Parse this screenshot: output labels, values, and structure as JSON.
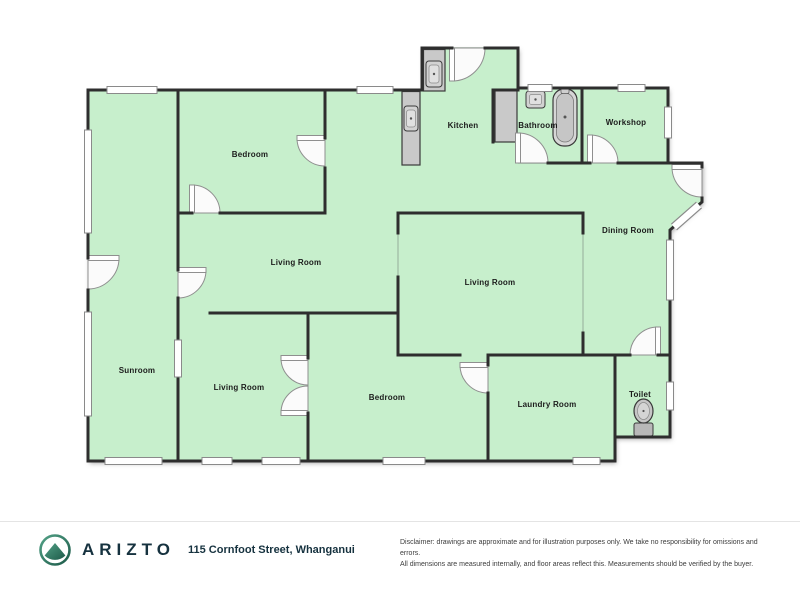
{
  "floorplan": {
    "rooms": [
      {
        "id": "bedroom-top",
        "label": "Bedroom"
      },
      {
        "id": "kitchen",
        "label": "Kitchen"
      },
      {
        "id": "bathroom",
        "label": "Bathroom"
      },
      {
        "id": "workshop",
        "label": "Workshop"
      },
      {
        "id": "dining-room",
        "label": "Dining Room"
      },
      {
        "id": "living-room-middle",
        "label": "Living Room"
      },
      {
        "id": "living-room-inner",
        "label": "Living Room"
      },
      {
        "id": "sunroom",
        "label": "Sunroom"
      },
      {
        "id": "living-room-bottom",
        "label": "Living Room"
      },
      {
        "id": "bedroom-bottom",
        "label": "Bedroom"
      },
      {
        "id": "laundry-room",
        "label": "Laundry Room"
      },
      {
        "id": "toilet",
        "label": "Toilet"
      }
    ],
    "fixtures": [
      "kitchen-counter",
      "kitchen-sink",
      "kitchen-counter-2",
      "kitchen-sink-2",
      "bathroom-counter-block",
      "bathroom-sink",
      "bathtub",
      "toilet-pan"
    ]
  },
  "footer": {
    "brand": "ARIZTO",
    "logo_icon": "mountain-in-circle",
    "address": "115 Cornfoot Street, Whanganui",
    "disclaimer_line1": "Disclaimer: drawings are approximate and for illustration purposes only. We take no responsibility for omissions and errors.",
    "disclaimer_line2": "All dimensions are measured internally, and floor areas reflect this. Measurements should be verified by the buyer."
  },
  "colors": {
    "room_fill": "#c7efcc",
    "wall": "#2e2e2e",
    "fixture_gray": "#c9c9c9",
    "door_white": "#fbfbfb",
    "brand_navy": "#16323f",
    "logo_teal": "#2e7d67"
  }
}
